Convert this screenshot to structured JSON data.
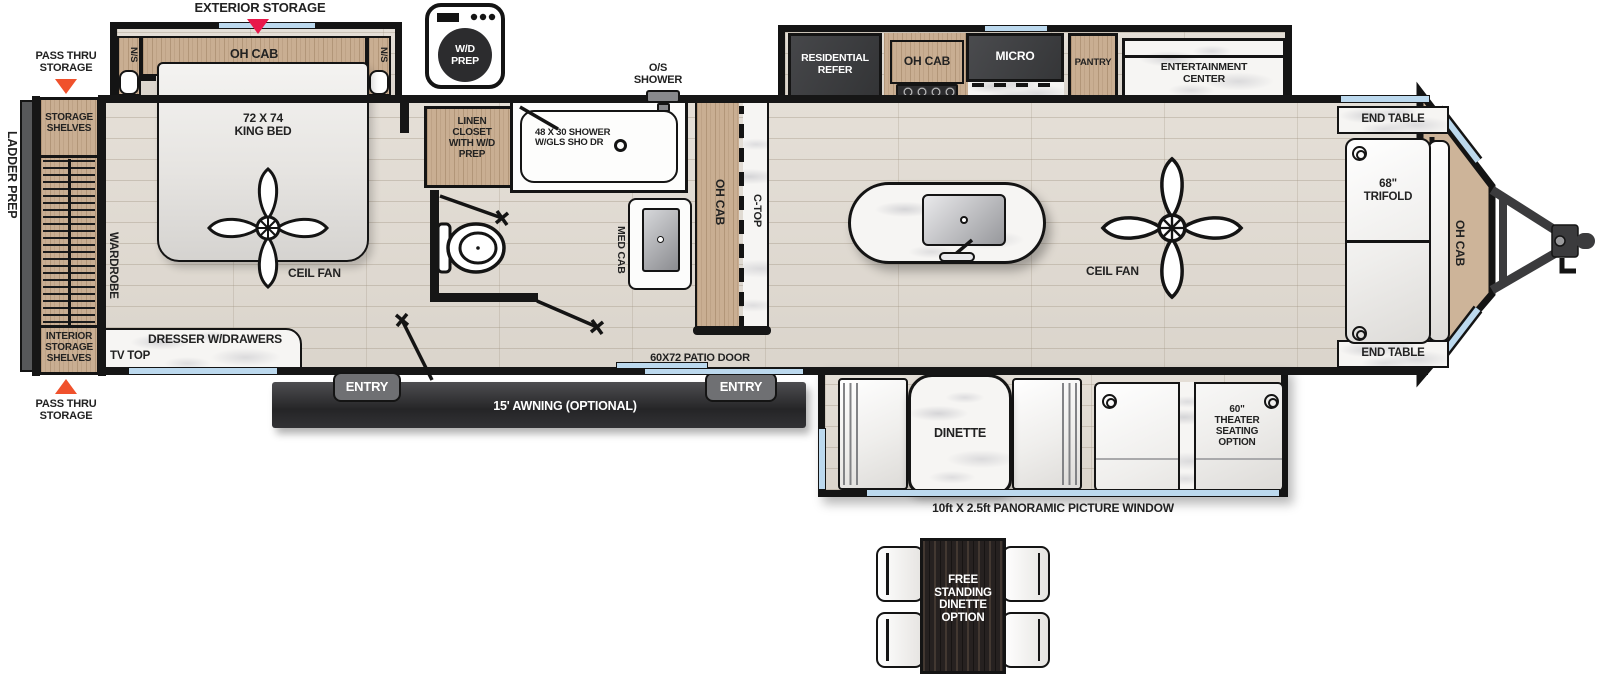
{
  "title": "RV travel trailer floorplan diagram",
  "colors": {
    "wall": "#161616",
    "floor_wood": "#ddd7cf",
    "cabinet_wood": "#c9ae92",
    "dark_fixture": "#3e3f41",
    "marble": "#f6f5f3",
    "window_blue": "#bcd9ee",
    "arrow_red": "#e8174a",
    "arrow_orange": "#f0512c",
    "awning_dark": "#2a2a2c"
  },
  "areas": {
    "exterior": {
      "exterior_storage": "EXTERIOR STORAGE",
      "pass_thru_storage": "PASS THRU STORAGE",
      "ladder_prep": "LADDER PREP",
      "entry": "ENTRY",
      "awning": "15' AWNING (OPTIONAL)",
      "patio_door": "60X72 PATIO DOOR",
      "panoramic_window": "10ft X 2.5ft PANORAMIC PICTURE WINDOW"
    },
    "rear": {
      "storage_shelves": "STORAGE SHELVES",
      "interior_storage_shelves": "INTERIOR STORAGE SHELVES",
      "wardrobe": "WARDROBE"
    },
    "bedroom": {
      "ns": "N/S",
      "oh_cab": "OH CAB",
      "king_bed": "72 X 74 KING BED",
      "ceil_fan": "CEIL FAN",
      "dresser": "DRESSER W/DRAWERS",
      "tv_top": "TV TOP"
    },
    "bath": {
      "wd_prep": "W/D PREP",
      "linen_closet": "LINEN CLOSET WITH W/D PREP",
      "shower": "48 X 30 SHOWER W/GLS SHO DR",
      "os_shower": "O/S SHOWER",
      "med_cab": "MED CAB"
    },
    "kitchen": {
      "oh_cab_counter": "OH CAB",
      "c_top": "C-TOP",
      "residential_refer": "RESIDENTIAL REFER",
      "oh_cab": "OH CAB",
      "micro": "MICRO",
      "pantry": "PANTRY",
      "entertainment_center": "ENTERTAINMENT CENTER"
    },
    "living": {
      "end_table": "END TABLE",
      "trifold": "68\" TRIFOLD",
      "oh_cab_front": "OH CAB",
      "ceil_fan": "CEIL FAN"
    },
    "dinette": {
      "dinette": "DINETTE",
      "theater_seating": "60\" THEATER SEATING OPTION"
    },
    "options": {
      "free_standing_dinette": "FREE STANDING DINETTE OPTION"
    }
  }
}
